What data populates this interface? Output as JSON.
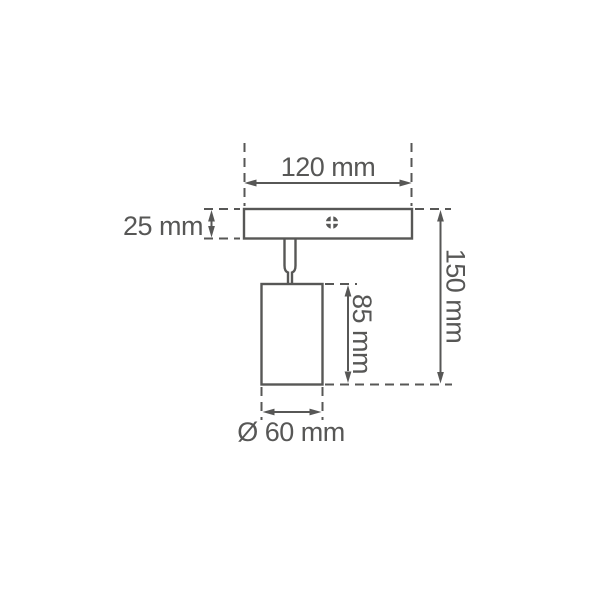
{
  "colors": {
    "line": "#575756",
    "background": "#ffffff"
  },
  "diagram": {
    "description": "technical dimension drawing of a single-head ceiling spotlight",
    "labels": {
      "plate_width": "120 mm",
      "plate_thickness": "25 mm",
      "overall_height": "150 mm",
      "body_height": "85 mm",
      "body_diameter": "Ø 60 mm"
    }
  }
}
